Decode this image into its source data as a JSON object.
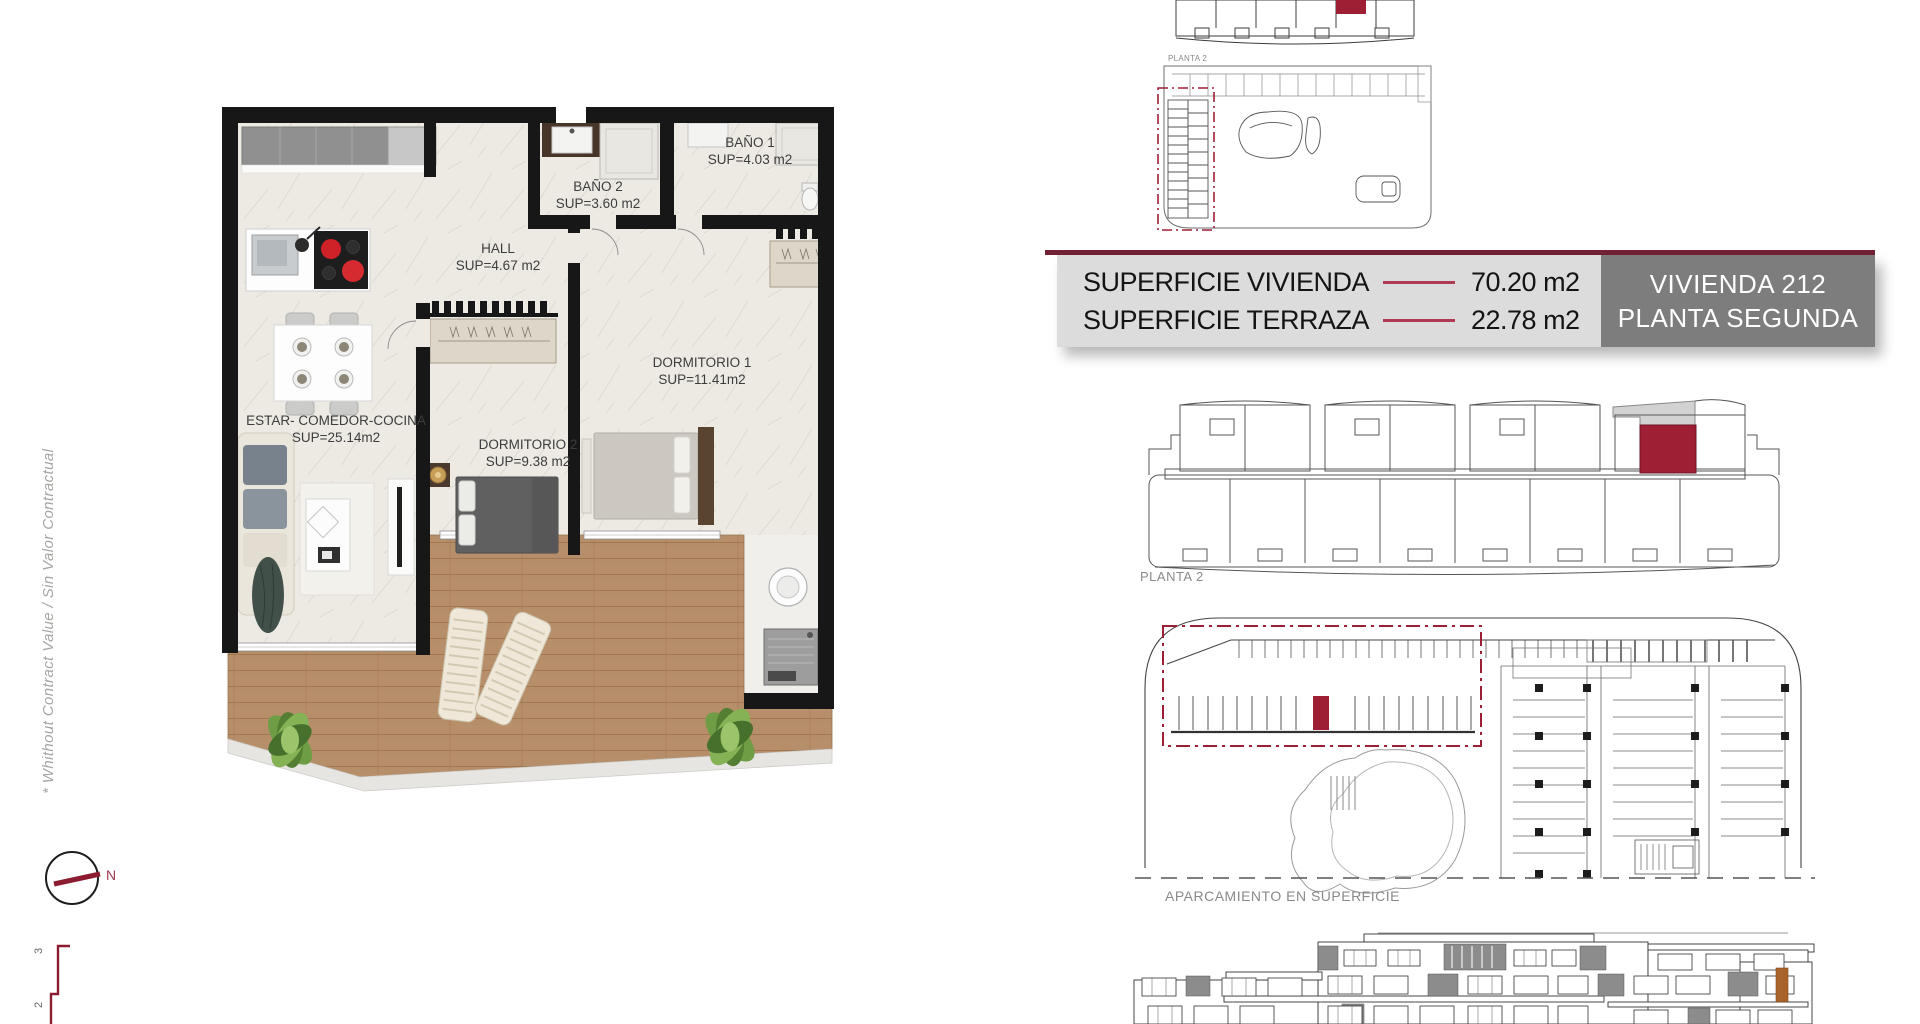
{
  "info_panel": {
    "rows": [
      {
        "label": "SUPERFICIE VIVIENDA",
        "value": "70.20 m2"
      },
      {
        "label": "SUPERFICIE TERRAZA",
        "value": "22.78 m2"
      }
    ],
    "unit_line1": "VIVIENDA 212",
    "unit_line2": "PLANTA SEGUNDA"
  },
  "floor_plan": {
    "rooms": [
      {
        "name": "ESTAR- COMEDOR-COCINA",
        "sup": "SUP=25.14m2"
      },
      {
        "name": "HALL",
        "sup": "SUP=4.67  m2"
      },
      {
        "name": "BAÑO 2",
        "sup": "SUP=3.60 m2"
      },
      {
        "name": "BAÑO 1",
        "sup": "SUP=4.03 m2"
      },
      {
        "name": "DORMITORIO 1",
        "sup": "SUP=11.41m2"
      },
      {
        "name": "DORMITORIO 2",
        "sup": "SUP=9.38 m2"
      }
    ]
  },
  "annotations": {
    "disclaimer": "* Whithout Contract Value / Sin Valor Contractual",
    "compass_north": "N",
    "scale_marks": [
      "3",
      "2"
    ]
  },
  "diagrams": {
    "site_plan_label": "PLANTA 2",
    "floor_key_label": "PLANTA 2",
    "parking_label": "APARCAMIENTO EN SUPERFICIE"
  },
  "palette": {
    "accent_dark": "#6f2233",
    "accent_red": "#9e1f33",
    "rule_red": "#b03a54",
    "panel_bg": "#dcdcdc",
    "unit_box_bg": "#7d7d7d",
    "wall_black": "#171717",
    "terrace_wood": "#b78e6a",
    "terrace_gray": "#d2d2d2"
  }
}
